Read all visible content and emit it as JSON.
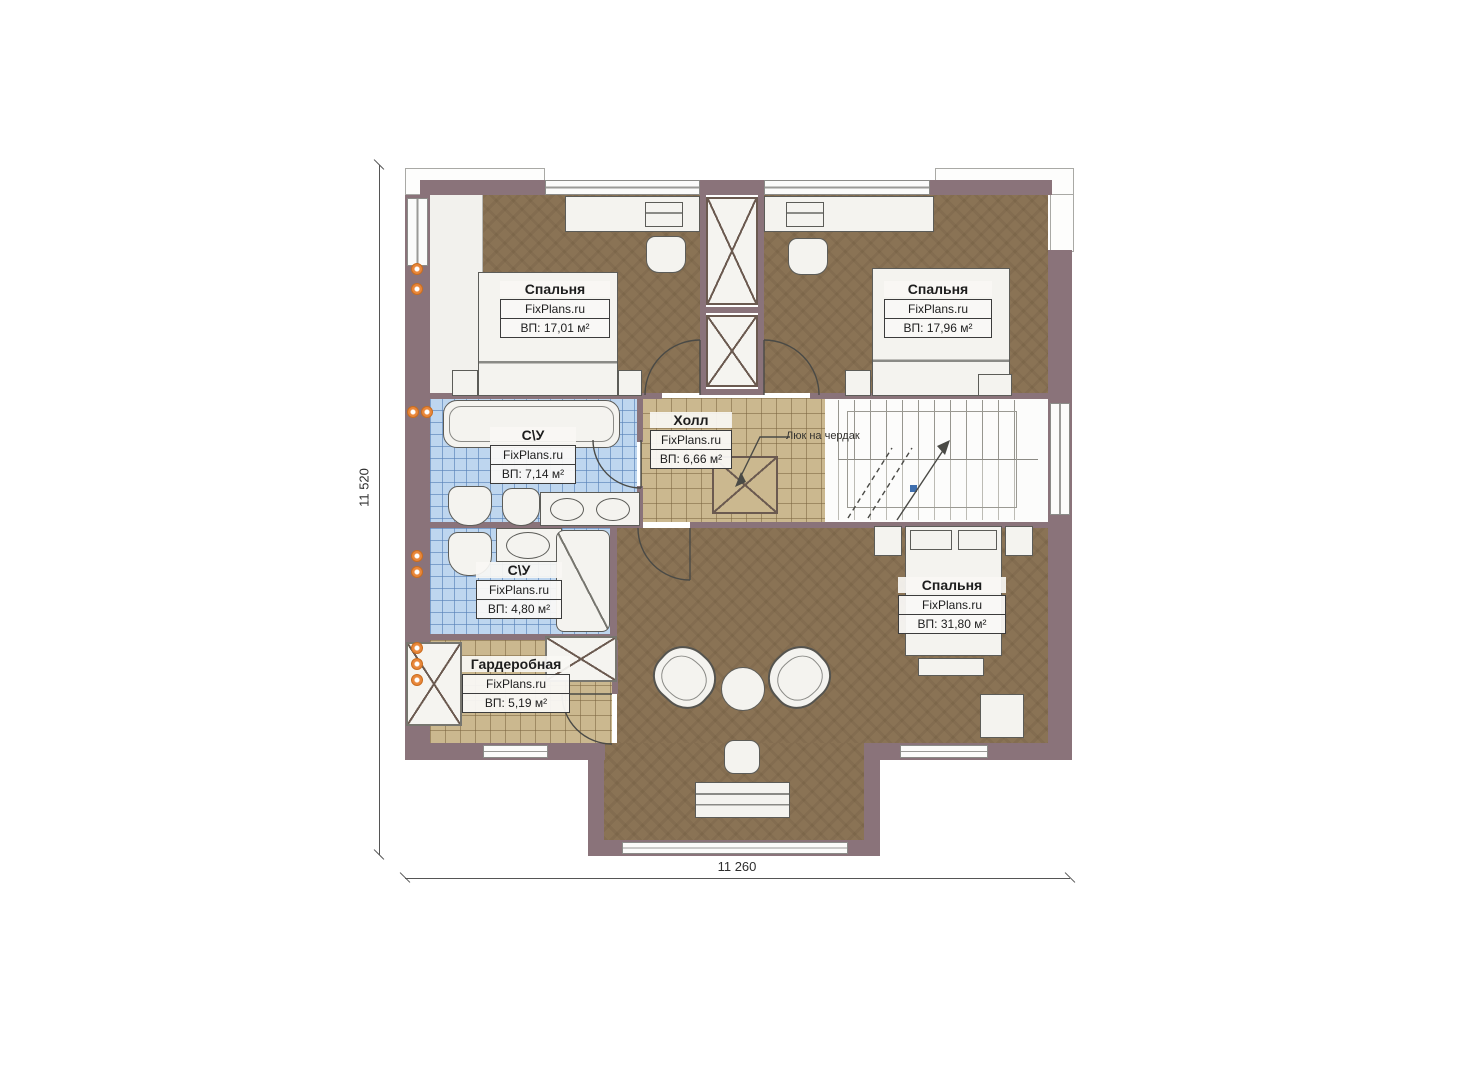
{
  "plan": {
    "dim_bottom": "11 260",
    "dim_left": "11 520",
    "attic_note": "Люк на чердак",
    "rooms": [
      {
        "name": "Спальня",
        "brand": "FixPlans.ru",
        "area": "ВП: 17,01 м²"
      },
      {
        "name": "Спальня",
        "brand": "FixPlans.ru",
        "area": "ВП: 17,96 м²"
      },
      {
        "name": "Холл",
        "brand": "FixPlans.ru",
        "area": "ВП: 6,66 м²"
      },
      {
        "name": "С\\У",
        "brand": "FixPlans.ru",
        "area": "ВП: 7,14 м²"
      },
      {
        "name": "С\\У",
        "brand": "FixPlans.ru",
        "area": "ВП: 4,80 м²"
      },
      {
        "name": "Гардеробная",
        "brand": "FixPlans.ru",
        "area": "ВП: 5,19 м²"
      },
      {
        "name": "Спальня",
        "brand": "FixPlans.ru",
        "area": "ВП: 31,80 м²"
      }
    ],
    "colors": {
      "wall": "#8a737a",
      "floor_wood": "#8a7355",
      "tile_hall": "#cbb88f",
      "tile_bath": "#bed6ef",
      "accent_orange": "#e9873a"
    }
  }
}
